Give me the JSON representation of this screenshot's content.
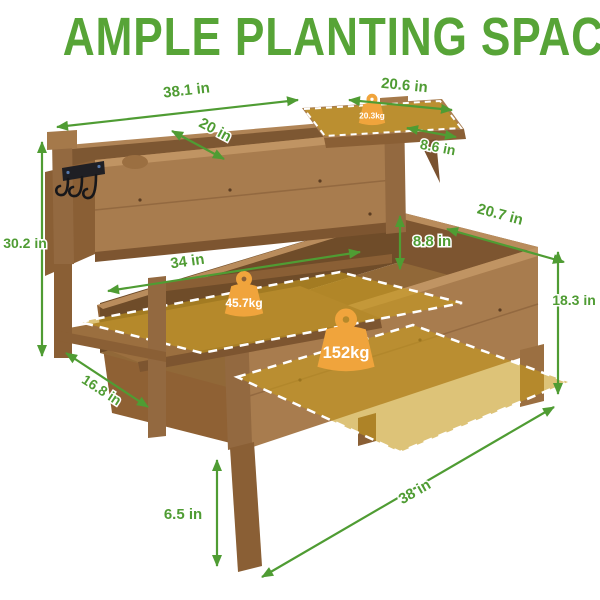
{
  "title": "AMPLE PLANTING SPACE",
  "dimensions": {
    "upper_length": "38.1 in",
    "upper_width": "20 in",
    "side_shelf_length": "20.6 in",
    "side_shelf_width": "8.6 in",
    "overall_height": "30.2 in",
    "lower_shelf_length": "34 in",
    "lower_shelf_width": "16.8 in",
    "bed_depth": "8.8 in",
    "bed_width": "20.7 in",
    "bed_height": "18.3 in",
    "leg_height": "6.5 in",
    "bed_length": "38 in"
  },
  "capacities": {
    "side_shelf": "20.3kg",
    "lower_shelf": "45.7kg",
    "bed": "152kg"
  },
  "colors": {
    "accent_green": "#4f9c33",
    "title_green": "#57a437",
    "wood": "#a87c4e",
    "wood_dark": "#6f4c29",
    "capacity_highlight": "#c79b1e",
    "weight_orange": "#f0a43c"
  }
}
